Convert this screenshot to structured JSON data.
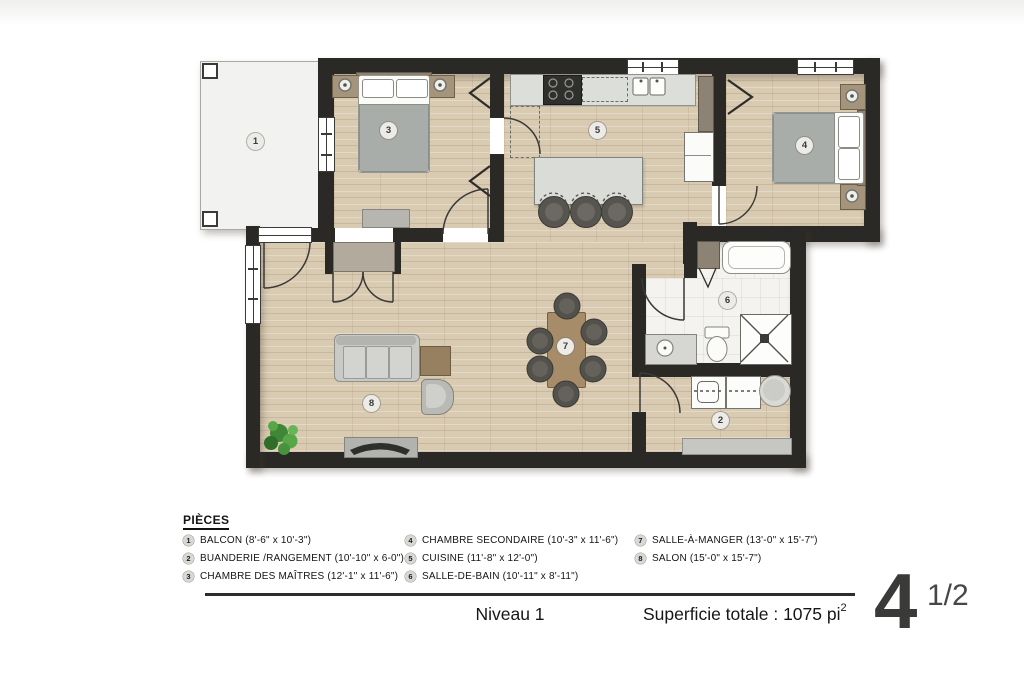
{
  "plan": {
    "room_labels": [
      {
        "id": "balcon",
        "num": "1"
      },
      {
        "id": "buanderie",
        "num": "2"
      },
      {
        "id": "chambre-des-maitres",
        "num": "3"
      },
      {
        "id": "chambre-secondaire",
        "num": "4"
      },
      {
        "id": "cuisine",
        "num": "5"
      },
      {
        "id": "salle-de-bain",
        "num": "6"
      },
      {
        "id": "salle-a-manger",
        "num": "7"
      },
      {
        "id": "salon",
        "num": "8"
      }
    ],
    "colors": {
      "wall": "#2b2925",
      "wood_floor": "#d9cab2",
      "tile_floor": "#f4f3f0",
      "balcony": "#f2f2f0"
    }
  },
  "legend": {
    "title": "PIÈCES",
    "items": [
      {
        "num": "1",
        "text": "BALCON (8'-6\" x 10'-3\")"
      },
      {
        "num": "2",
        "text": "BUANDERIE /RANGEMENT (10'-10\" x 6-0\")"
      },
      {
        "num": "3",
        "text": "CHAMBRE DES MAÎTRES (12'-1\" x 11'-6\")"
      },
      {
        "num": "4",
        "text": "CHAMBRE SECONDAIRE (10'-3\" x 11'-6\")"
      },
      {
        "num": "5",
        "text": "CUISINE (11'-8\" x 12'-0\")"
      },
      {
        "num": "6",
        "text": "SALLE-DE-BAIN (10'-11\" x 8'-11\")"
      },
      {
        "num": "7",
        "text": "SALLE-À-MANGER (13'-0\" x 15'-7\")"
      },
      {
        "num": "8",
        "text": "SALON (15'-0\" x 15'-7\")"
      }
    ]
  },
  "footer": {
    "level": "Niveau 1",
    "area_text": "Superficie totale : 1075 pi",
    "area_exponent": "2",
    "unit_number": "4",
    "unit_fraction": "1/2"
  }
}
